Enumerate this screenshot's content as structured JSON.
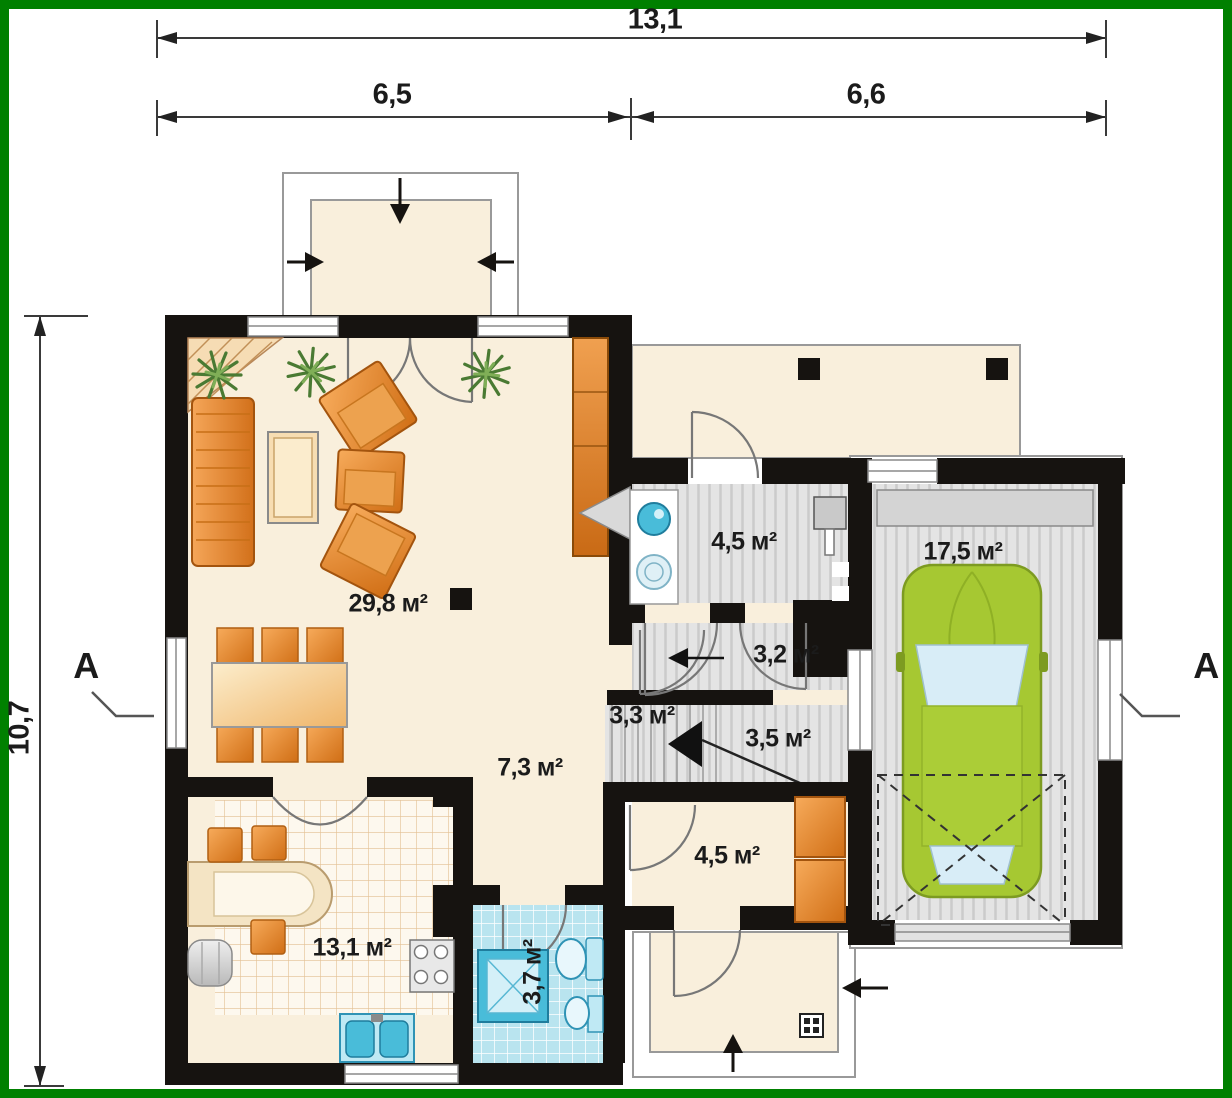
{
  "plan": {
    "title": "house-ground-floor-plan",
    "dimensions": {
      "total_width": "13,1",
      "left_width": "6,5",
      "right_width": "6,6",
      "side_height": "10,7"
    },
    "section_marks": {
      "left": "A",
      "right": "A"
    },
    "rooms": [
      {
        "id": "living-room",
        "label": "29,8 м²"
      },
      {
        "id": "bathroom-upper",
        "label": "4,5 м²"
      },
      {
        "id": "garage",
        "label": "17,5 м²"
      },
      {
        "id": "corridor",
        "label": "3,2 м²"
      },
      {
        "id": "stairs",
        "label": "3,3 м²"
      },
      {
        "id": "landing",
        "label": "3,5 м²"
      },
      {
        "id": "hall",
        "label": "7,3 м²"
      },
      {
        "id": "room-lower",
        "label": "4,5 м²"
      },
      {
        "id": "kitchen",
        "label": "13,1 м²"
      },
      {
        "id": "bathroom-lower",
        "label": "3,7 м²"
      }
    ],
    "colors": {
      "frame_green": "#008000",
      "wall_black": "#161310",
      "floor_beige": "#f9efdc",
      "floor_gray": "#e4e4e4",
      "tile_blue": "#b9e4ef",
      "fixture_blue": "#49bcd9",
      "furniture_orange": "#e0812a",
      "car_green": "#a6c832"
    }
  }
}
